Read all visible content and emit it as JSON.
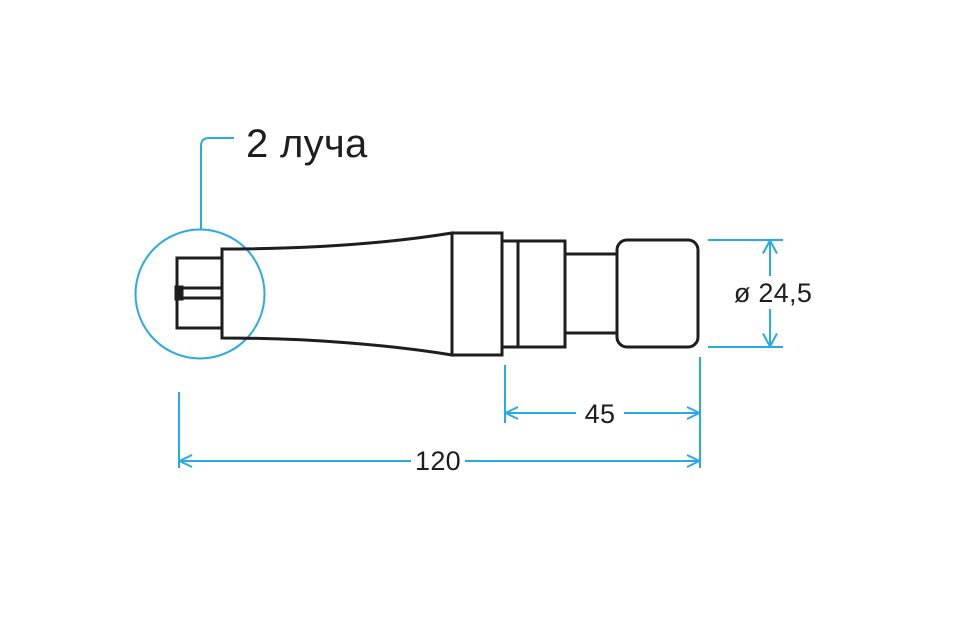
{
  "figure": {
    "type": "technical-dimension-drawing",
    "callout_label": "2 луча",
    "dimensions": {
      "diameter": {
        "label": "ø 24,5"
      },
      "length_front": {
        "label": "45"
      },
      "length_total": {
        "label": "120"
      }
    },
    "colors": {
      "dimension_blue": "#29ABE2",
      "outline_black": "#1E1E1E",
      "background": "#FFFFFF"
    }
  }
}
